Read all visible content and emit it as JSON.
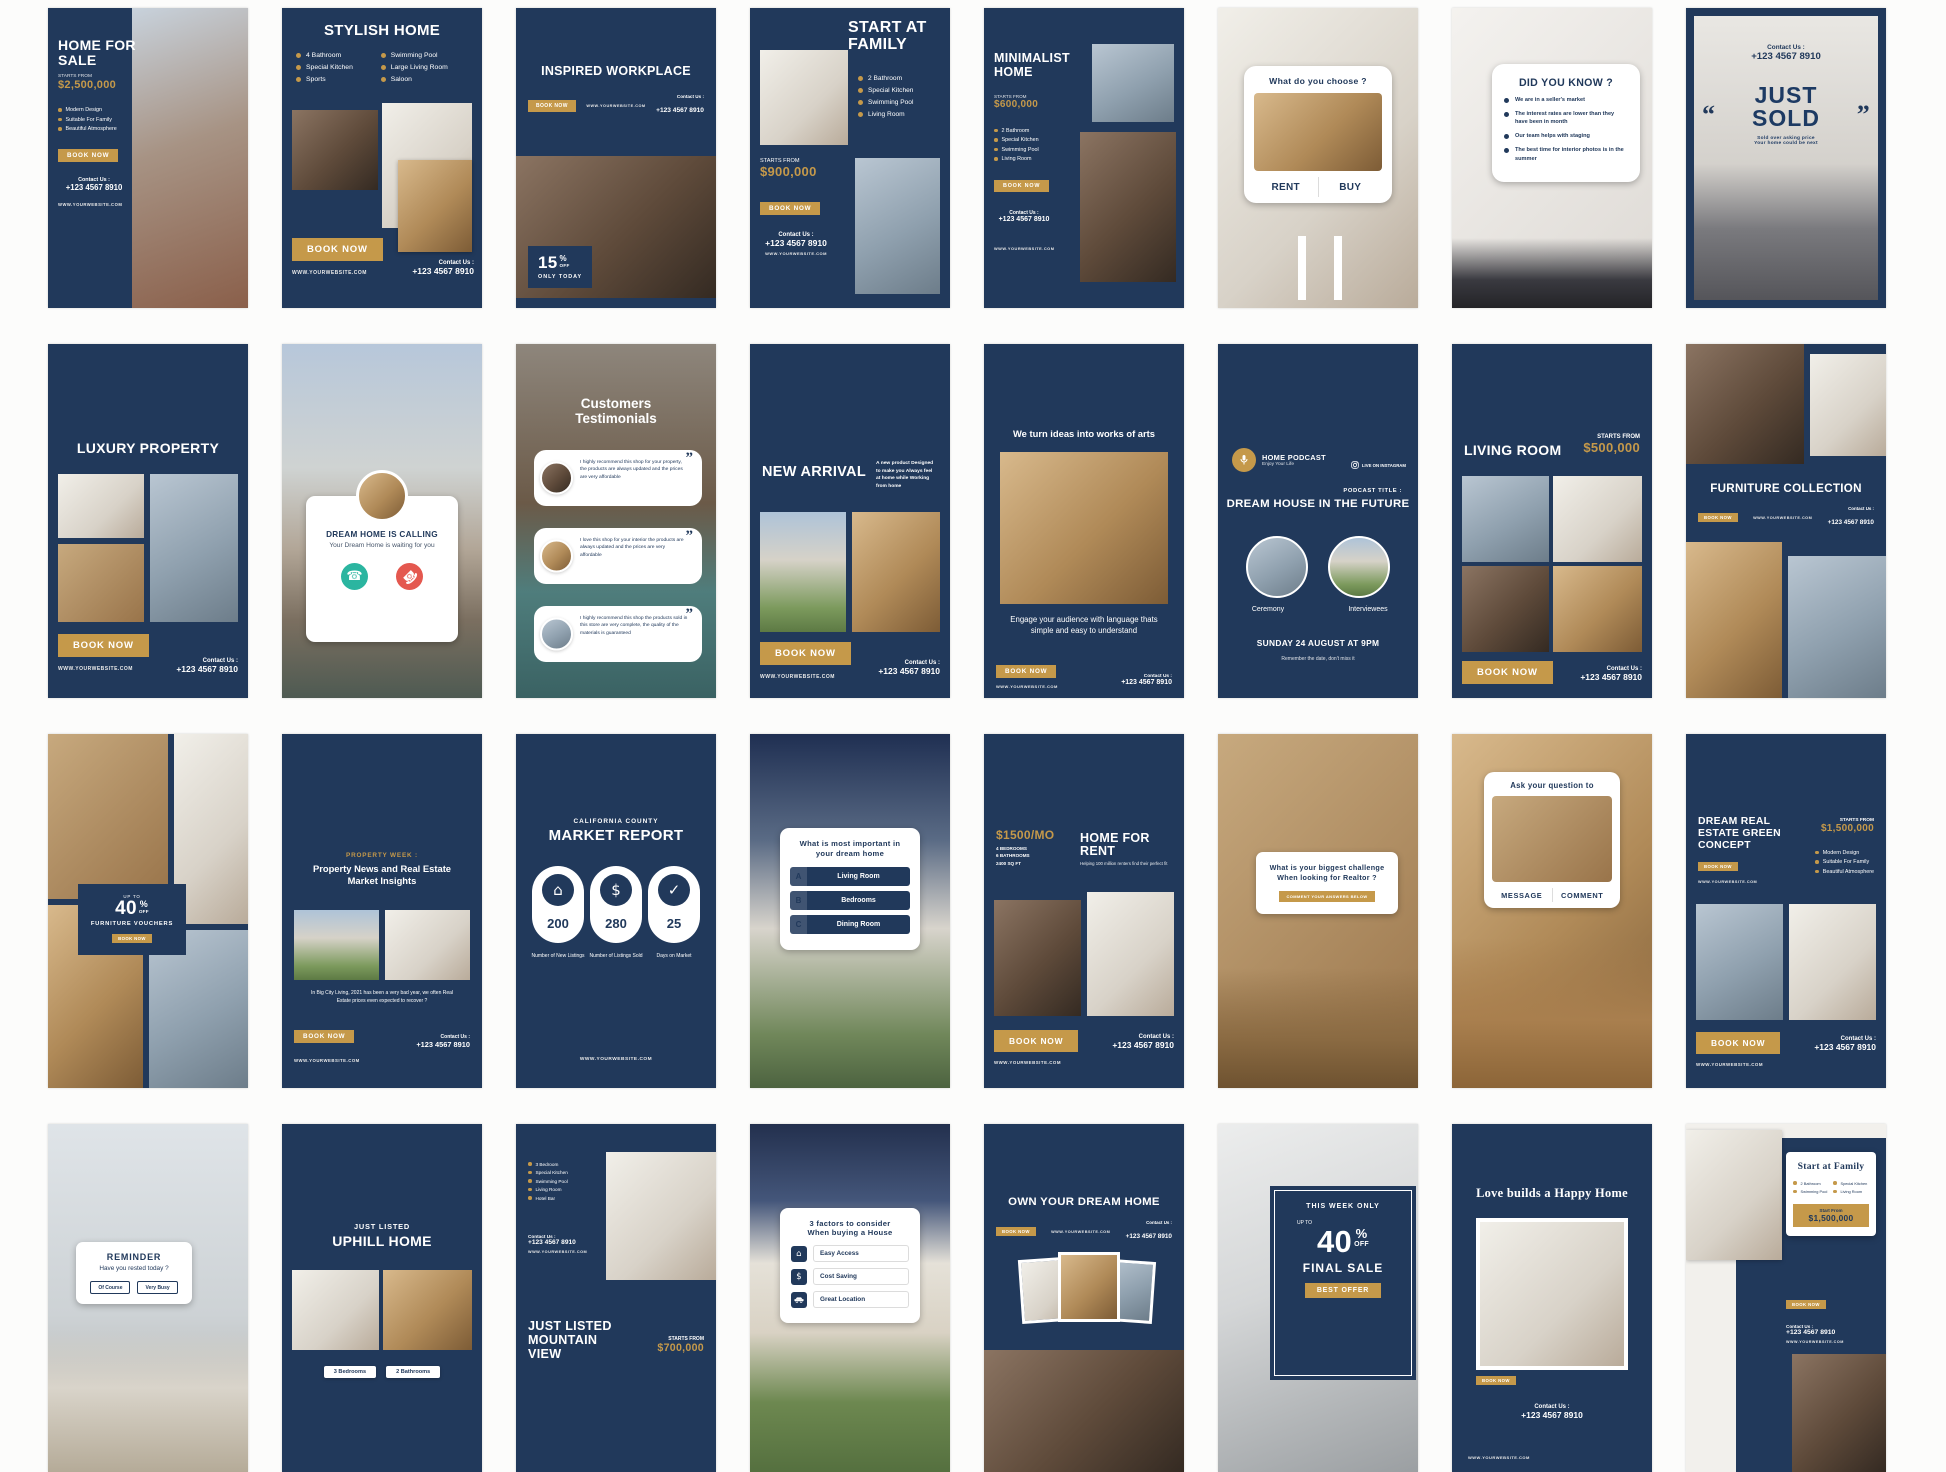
{
  "colors": {
    "navy": "#21395b",
    "gold": "#c5994a",
    "call_green": "#2bb5a0",
    "call_red": "#e4584f"
  },
  "common": {
    "website": "WWW.YOURWEBSITE.COM",
    "contact_label": "Contact Us :",
    "phone": "+123 4567 8910",
    "book_now": "BOOK NOW",
    "starts_from": "STARTS FROM"
  },
  "cards": {
    "r1c1": {
      "title": "HOME FOR SALE",
      "price": "$2,500,000",
      "features": [
        "Modern Design",
        "Suitable For Family",
        "Beautiful Atmosphere"
      ]
    },
    "r1c2": {
      "title": "STYLISH HOME",
      "features_left": [
        "4 Bathroom",
        "Special Kitchen",
        "Sports"
      ],
      "features_right": [
        "Swimming Pool",
        "Large Living Room",
        "Saloon"
      ]
    },
    "r1c3": {
      "title": "INSPIRED WORKPLACE",
      "discount_value": "15",
      "discount_unit": "%",
      "discount_off": "OFF",
      "discount_note": "ONLY TODAY"
    },
    "r1c4": {
      "title": "START AT FAMILY",
      "features": [
        "2 Bathroom",
        "Special Kitchen",
        "Swimming Pool",
        "Living Room"
      ],
      "price": "$900,000"
    },
    "r1c5": {
      "title": "MINIMALIST HOME",
      "price": "$600,000",
      "features": [
        "2 Bathroom",
        "Special Kitchen",
        "Swimming Pool",
        "Living Room"
      ]
    },
    "r1c6": {
      "question": "What do you choose ?",
      "option_left": "RENT",
      "option_right": "BUY"
    },
    "r1c7": {
      "title": "DID YOU KNOW ?",
      "facts": [
        "We are in a seller's market",
        "The interest rates are lower than they have been in month",
        "Our team helps with staging",
        "The best time for interior photos is in the summer"
      ]
    },
    "r1c8": {
      "quote_open": "“",
      "quote_close": "”",
      "title_line1": "JUST",
      "title_line2": "SOLD",
      "note_line1": "Sold over asking price",
      "note_line2": "Your home could be next"
    },
    "r2c1": {
      "title": "LUXURY PROPERTY"
    },
    "r2c2": {
      "heading": "DREAM HOME IS CALLING",
      "subheading": "Your Dream Home is waiting for you"
    },
    "r2c3": {
      "title_line1": "Customers",
      "title_line2": "Testimonials",
      "quote_mark": "”",
      "testimonials": [
        "I highly recommend this shop for your property, the products are always updated and the prices are very affordable",
        "I love this shop for your interior the products are always updated and the prices are very affordable",
        "I highly recommend this shop the products sold in this store are very complete, the quality of the materials is guaranteed"
      ]
    },
    "r2c4": {
      "title": "NEW ARRIVAL",
      "note": "A new product Designed to make you Always feel at home while Working from home"
    },
    "r2c5": {
      "title": "We turn ideas into works of arts",
      "caption": "Engage your audience with language thats simple and easy to understand"
    },
    "r2c6": {
      "brand": "HOME PODCAST",
      "brand_sub": "Enjoy Your Life",
      "live_label": "LIVE ON INSTAGRAM",
      "podcast_title_label": "PODCAST TITLE :",
      "podcast_title": "DREAM HOUSE IN THE FUTURE",
      "speaker_left": "Ceremony",
      "speaker_right": "Interviewees",
      "schedule": "SUNDAY 24 AUGUST AT 9PM",
      "schedule_note": "Remember the date, don't miss it"
    },
    "r2c7": {
      "title": "LIVING ROOM",
      "price": "$500,000"
    },
    "r2c8": {
      "title": "FURNITURE COLLECTION"
    },
    "r3c1": {
      "upto": "UP TO",
      "discount": "40",
      "pct": "%",
      "off": "OFF",
      "label": "FURNITURE VOUCHERS"
    },
    "r3c2": {
      "kicker": "PROPERTY WEEK :",
      "title": "Property News and Real Estate Market Insights",
      "body": "In Big City Living, 2021 has been a very bad year, we often Real Estate prices even expected to recover ?"
    },
    "r3c3": {
      "kicker": "CALIFORNIA COUNTY",
      "title": "MARKET REPORT",
      "stats": [
        {
          "value": "200",
          "label": "Number of New Listings"
        },
        {
          "value": "280",
          "label": "Number of Listings Sold"
        },
        {
          "value": "25",
          "label": "Days on Market"
        }
      ]
    },
    "r3c4": {
      "question": "What is most important in your dream home",
      "options": [
        {
          "key": "A",
          "label": "Living Room"
        },
        {
          "key": "B",
          "label": "Bedrooms"
        },
        {
          "key": "C",
          "label": "Dining Room"
        }
      ]
    },
    "r3c5": {
      "price": "$1500/MO",
      "specs": [
        "4 BEDROOMS",
        "6 BATHROOMS",
        "2400 SQ FT"
      ],
      "title": "HOME FOR RENT",
      "tagline": "Helping 100 million renters find their perfect fit"
    },
    "r3c6": {
      "question": "What is your biggest challenge When looking for Realtor ?",
      "button": "COMMENT YOUR ANSWERS BELOW"
    },
    "r3c7": {
      "heading": "Ask your question to",
      "option_left": "MESSAGE",
      "option_right": "COMMENT"
    },
    "r3c8": {
      "title": "DREAM REAL ESTATE GREEN CONCEPT",
      "price": "$1,500,000",
      "features": [
        "Modern Design",
        "Suitable For Family",
        "Beautiful Atmosphere"
      ]
    },
    "r4c1": {
      "label": "REMINDER",
      "question": "Have you rested today ?",
      "option_left": "Of Course",
      "option_right": "Very Busy"
    },
    "r4c2": {
      "kicker": "JUST LISTED",
      "title": "UPHILL HOME",
      "chip_left": "3 Bedrooms",
      "chip_right": "2 Bathrooms"
    },
    "r4c3": {
      "features": [
        "3 Bedroom",
        "Special Kitchen",
        "Swimming Pool",
        "Living Room",
        "Hotel Bar"
      ],
      "title": "JUST LISTED MOUNTAIN VIEW",
      "price": "$700,000"
    },
    "r4c4": {
      "heading_line1": "3 factors to consider",
      "heading_line2": "When buying a House",
      "factors": [
        "Easy Access",
        "Cost Saving",
        "Great Location"
      ]
    },
    "r4c5": {
      "title": "OWN YOUR DREAM HOME"
    },
    "r4c6": {
      "kicker": "THIS WEEK ONLY",
      "upto": "UP TO",
      "discount": "40",
      "pct": "%",
      "off": "OFF",
      "title": "FINAL SALE",
      "badge": "BEST OFFER"
    },
    "r4c7": {
      "title": "Love builds a Happy Home"
    },
    "r4c8": {
      "title": "Start at Family",
      "features_left": [
        "2 Bathroom",
        "Swimming Pool"
      ],
      "features_right": [
        "Special Kitchen",
        "Living Room"
      ],
      "price_label": "Start From",
      "price": "$1,500,000"
    }
  }
}
